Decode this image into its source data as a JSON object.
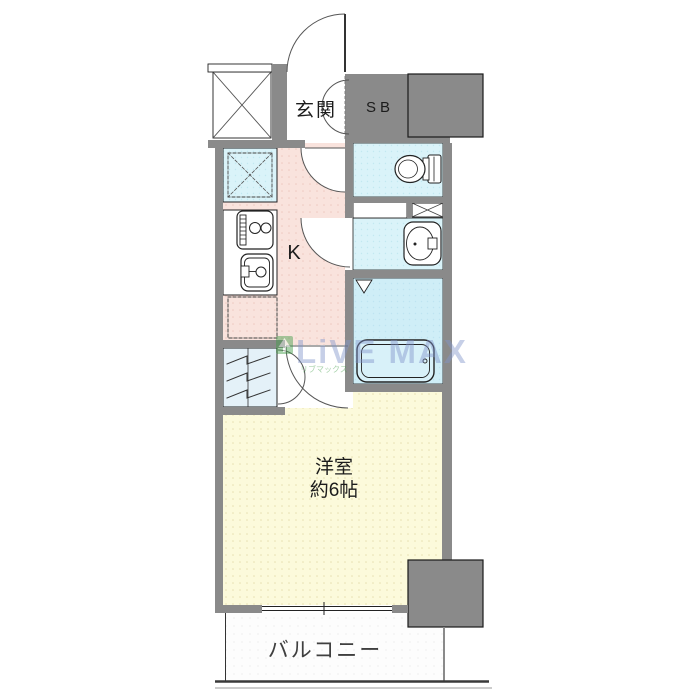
{
  "labels": {
    "entrance": "玄関",
    "shoe_box": "SB",
    "kitchen": "K",
    "room_name": "洋室",
    "room_size": "約6帖",
    "balcony": "バルコニー"
  },
  "watermark": {
    "brand": "LiVE MAX",
    "sub": "リブマックス"
  },
  "colors": {
    "wall_gray": "#8a8a8a",
    "kitchen_pink": "#f9e3dd",
    "room_cream": "#fcfadb",
    "wet_cyan": "#daf3f9",
    "bath_cyan": "#cfeef7",
    "closet_blue": "#e4f1f8",
    "shoebox_lavender": "#e2e5f0",
    "watermark_blue": "#8296cc",
    "watermark_green": "#3f9c46"
  }
}
